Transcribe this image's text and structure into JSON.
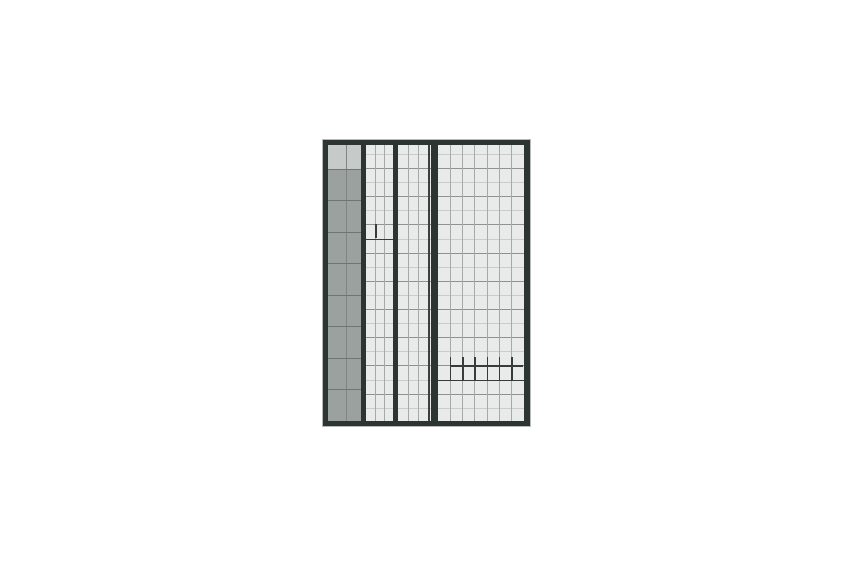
{
  "canvas": {
    "width": 850,
    "height": 567,
    "background": "#ffffff"
  },
  "sheet": {
    "x": 321.5,
    "y": 138.5,
    "outer_width": 209,
    "outer_height": 288,
    "colors": {
      "frame_dark": "#2c3531",
      "frame_outline": "#b6bbb9",
      "paper": "#e9eaea",
      "gray_fill": "#9aa19e",
      "gray_header": "#c6cac8",
      "gray_row_line": "#6f7572",
      "gray_divider": "#7f8582",
      "column_line": "#a5aaa7",
      "row_line_dark": "#8e938f",
      "row_line_light": "#c9ccca",
      "heavy_mark": "#363d39",
      "extra_rule": "#3a413d"
    },
    "frame": {
      "outline_px": 1,
      "left": 5.5,
      "top": 5,
      "right": 6,
      "bottom": 5
    },
    "interior": {
      "x": 328,
      "y": 144.5,
      "right": 523.5,
      "bottom": 420.5
    },
    "gray_column": {
      "x": 328,
      "right": 360.5,
      "divider_x": 346,
      "header_bottom": 168.5,
      "row_lines": [
        168.5,
        200,
        231.5,
        263,
        294.5,
        326,
        357.5,
        389
      ]
    },
    "bars": [
      {
        "x": 360.5,
        "right": 366
      },
      {
        "x": 392.5,
        "right": 398
      },
      {
        "x": 431,
        "right": 437.5
      }
    ],
    "sections": [
      {
        "name": "section-a",
        "x": 366,
        "right": 392.5,
        "col_lines": [
          374.8,
          383.7
        ]
      },
      {
        "name": "section-b",
        "x": 398,
        "right": 428,
        "col_lines": [
          408,
          418
        ],
        "extra_rule_x": 428
      },
      {
        "name": "section-c",
        "x": 437.5,
        "right": 523.5,
        "col_lines": [
          449.8,
          462.1,
          474.4,
          486.6,
          498.9,
          511.2
        ]
      }
    ],
    "row_area": {
      "x": 360.5,
      "right": 523.5
    },
    "row_lines_dark": [
      168,
      196.2,
      224.4,
      252.6,
      280.8,
      309,
      337.2,
      365.4,
      393.6
    ],
    "row_lines_light": [
      153.9,
      182.1,
      210.3,
      238.5,
      266.7,
      294.9,
      323.1,
      351.3,
      379.5,
      407.7
    ],
    "marks": {
      "cell_mark": {
        "h_line": {
          "y": 238.5,
          "x1": 366,
          "x2": 392.5
        },
        "v_line": {
          "x": 374.8,
          "y1": 224.4,
          "y2": 238.5
        }
      },
      "step_mark": {
        "h_low": {
          "y": 379.5,
          "x1": 437.5,
          "x2": 523.5
        },
        "h_high": {
          "y": 365.4,
          "x1": 449.8,
          "x2": 523.5
        },
        "ticks_x": [
          449.8,
          462.1,
          474.4,
          486.6,
          498.9,
          511.2
        ],
        "tick_y1": 357,
        "tick_y2": 379.5
      }
    }
  }
}
